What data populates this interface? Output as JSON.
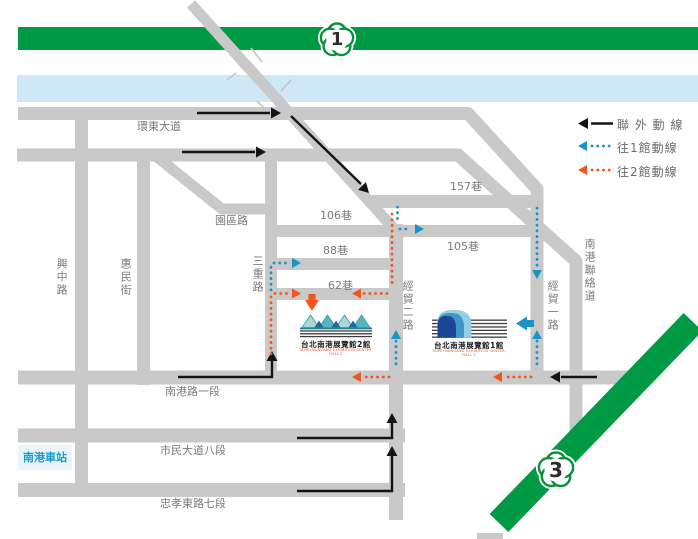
{
  "legend": {
    "outer": "聯 外 動 線",
    "to_hall1": "往1館動線",
    "to_hall2": "往2館動線"
  },
  "highways": {
    "h1": "1",
    "h3": "3"
  },
  "roads": {
    "huandong": "環東大道",
    "yuanqu": "園區路",
    "lane157": "157巷",
    "lane106": "106巷",
    "lane105": "105巷",
    "lane88": "88巷",
    "lane62": "62巷",
    "sanchong": "三重路",
    "jingmao2": "經貿二路",
    "jingmao1": "經貿一路",
    "lianluo": "南港聯絡道",
    "xingzhong": "興中路",
    "huimin": "惠民街",
    "nangang1": "南港路一段",
    "civic8": "市民大道八段",
    "zhongxiao7": "忠孝東路七段"
  },
  "station": {
    "label": "南港車站"
  },
  "halls": {
    "hall2": {
      "name": "台北南港展覽館2館",
      "name_en": "TAIPEI NANGANG EXHIBITION CENTER, HALL 2"
    },
    "hall1": {
      "name": "台北南港展覽館1館",
      "name_en": "TAIPEI NANGANG EXHIBITION CENTER, HALL 1"
    }
  },
  "colors": {
    "road_gray": "#c9c9c9",
    "highway_green": "#009a44",
    "river_blue": "#cfe8f7",
    "route_outer_black": "#141414",
    "route_hall1_blue": "#1b93c6",
    "route_hall2_orange": "#f0561d"
  }
}
